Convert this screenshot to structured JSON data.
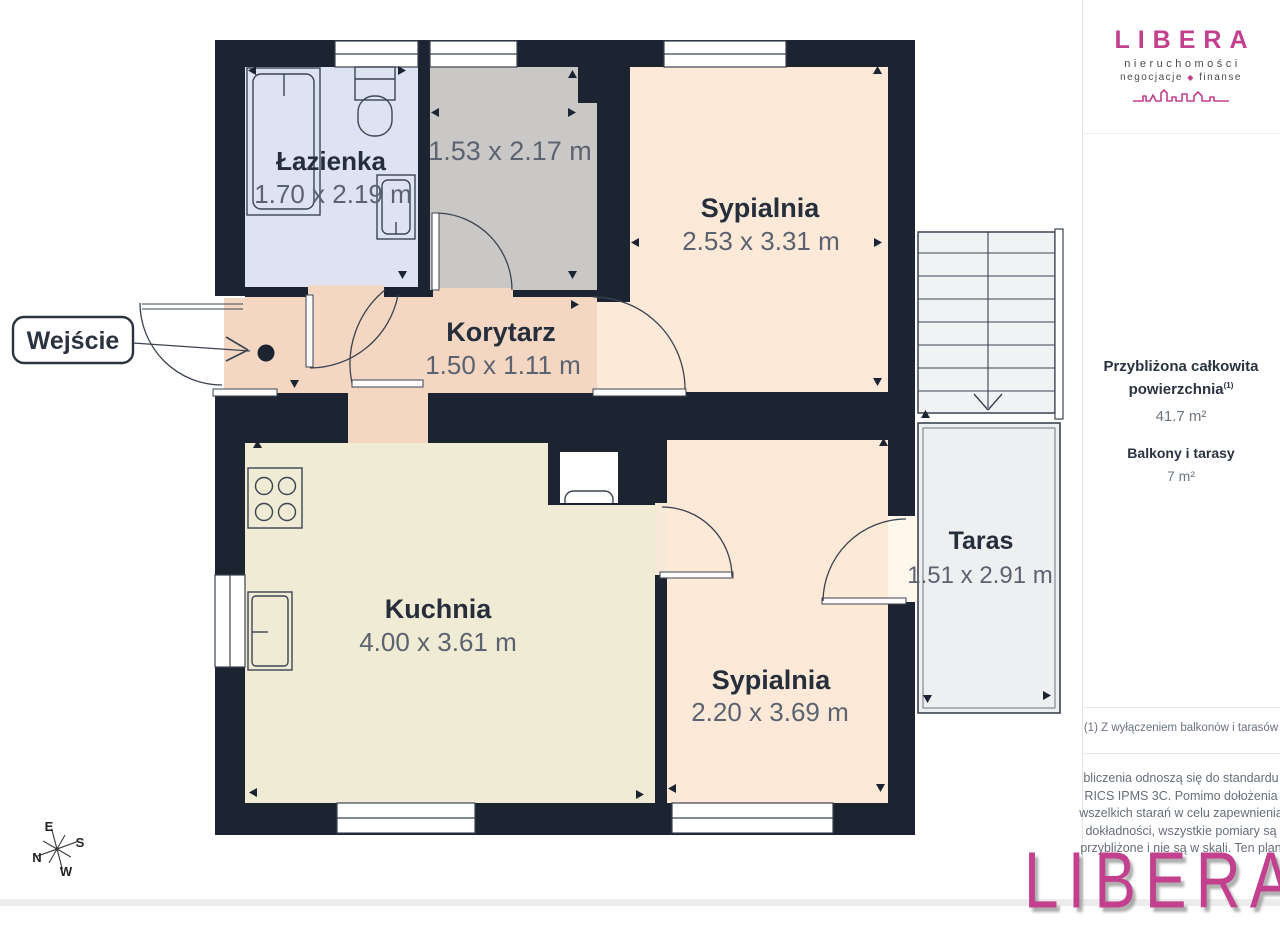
{
  "plan": {
    "entrance_label": "Wejście",
    "rooms": [
      {
        "name": "Łazienka",
        "dims": "1.70 x 2.19 m"
      },
      {
        "name": "",
        "dims": "1.53 x 2.17 m"
      },
      {
        "name": "Sypialnia",
        "dims": "2.53 x 3.31 m"
      },
      {
        "name": "Korytarz",
        "dims": "1.50 x 1.11 m"
      },
      {
        "name": "Kuchnia",
        "dims": "4.00 x 3.61 m"
      },
      {
        "name": "Sypialnia",
        "dims": "2.20 x 3.69 m"
      },
      {
        "name": "Taras",
        "dims": "1.51 x 2.91 m"
      }
    ],
    "compass": {
      "n": "N",
      "e": "E",
      "s": "S",
      "w": "W"
    },
    "colors": {
      "wall": "#1c2431",
      "bathroom": "#dde3f0",
      "utility": "#c9c8c6",
      "bedroom": "#fce9d8",
      "corridor": "#f3d7c3",
      "kitchen": "#f0ebd4",
      "terrace": "#edeff0",
      "accent_pink": "#c2408e",
      "label_dark": "#262d3b",
      "label_gray": "#5c6370"
    }
  },
  "sidebar": {
    "logo": {
      "brand": "LIBERA",
      "tagline1": "nieruchomości",
      "tagline_left": "negocjacje",
      "tagline_separator": "◆",
      "tagline_right": "finanse"
    },
    "area": {
      "title_line1": "Przybliżona całkowita",
      "title_line2": "powierzchnia",
      "superscript": "(1)",
      "total": "41.7 m²",
      "balcony_label": "Balkony i tarasy",
      "balcony_value": "7 m²"
    },
    "footnote": "(1) Z wyłączeniem balkonów i tarasów",
    "disclaimer_lines": [
      "bliczenia odnoszą się do standardu",
      "RICS IPMS 3C. Pomimo dołożenia",
      "wszelkich starań w celu zapewnienia",
      "dokładności, wszystkie pomiary są",
      "przybliżone i nie są w skali. Ten plan"
    ],
    "watermark": "LIBERA"
  }
}
